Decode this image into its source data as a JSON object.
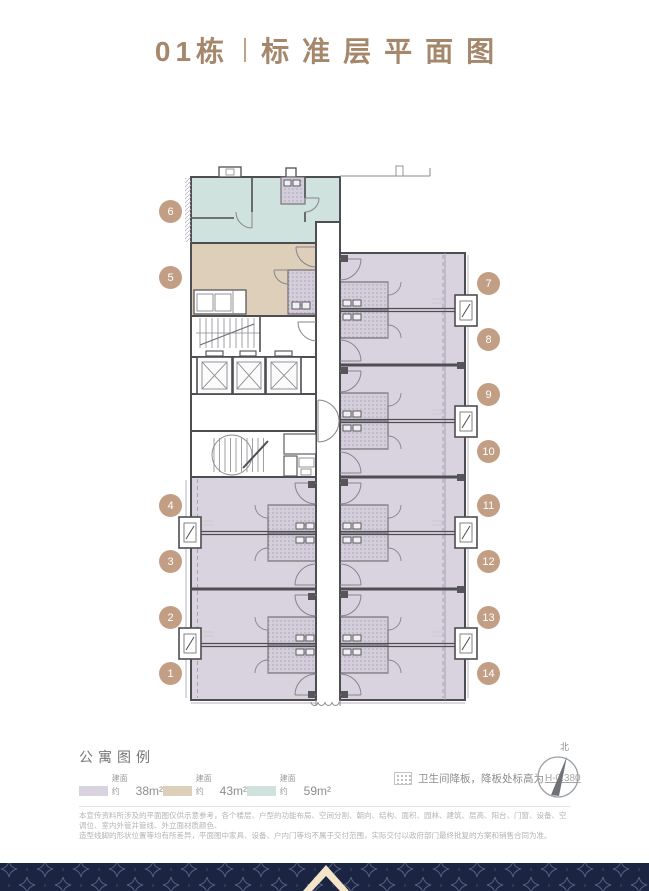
{
  "title": {
    "block": "01栋",
    "name": "标准层平面图"
  },
  "plan": {
    "units": [
      {
        "n": "1"
      },
      {
        "n": "2"
      },
      {
        "n": "3"
      },
      {
        "n": "4"
      },
      {
        "n": "5"
      },
      {
        "n": "6"
      },
      {
        "n": "7"
      },
      {
        "n": "8"
      },
      {
        "n": "9"
      },
      {
        "n": "10"
      },
      {
        "n": "11"
      },
      {
        "n": "12"
      },
      {
        "n": "13"
      },
      {
        "n": "14"
      }
    ],
    "unit_fill_colors": {
      "38": "#d9d3e0",
      "43": "#decfba",
      "59": "#cfe2dd"
    }
  },
  "legend": {
    "heading": "公寓图例",
    "items": [
      {
        "prefix": "建面约",
        "area": "38m²",
        "color": "#d9d3e0"
      },
      {
        "prefix": "建面约",
        "area": "43m²",
        "color": "#decfba"
      },
      {
        "prefix": "建面约",
        "area": "59m²",
        "color": "#cfe2dd"
      }
    ],
    "note_text": "卫生间降板，降板处标高为",
    "note_value": "H-0.380",
    "compass_label": "北"
  },
  "disclaimer": {
    "line1": "本宣传资料所涉及的平面图仅供示意参考，各个楼层、户型的功能布局、空间分割、朝向、结构、面积、园林、建筑、层高、阳台、门窗、设备、空调位、室内外管井管线、外立面材质颜色、",
    "line2": "造型线脚的形状位置等均有所差异，平面图中家具、设备、户内门等均不属于交付范围，实际交付以政府部门最终批复的方案和销售合同为准。"
  },
  "colors": {
    "title": "#a5876b",
    "badge": "#c29e85",
    "wall": "#4e4e52",
    "footer_navy": "#1b2440",
    "footer_cream": "#f5e5c8"
  }
}
